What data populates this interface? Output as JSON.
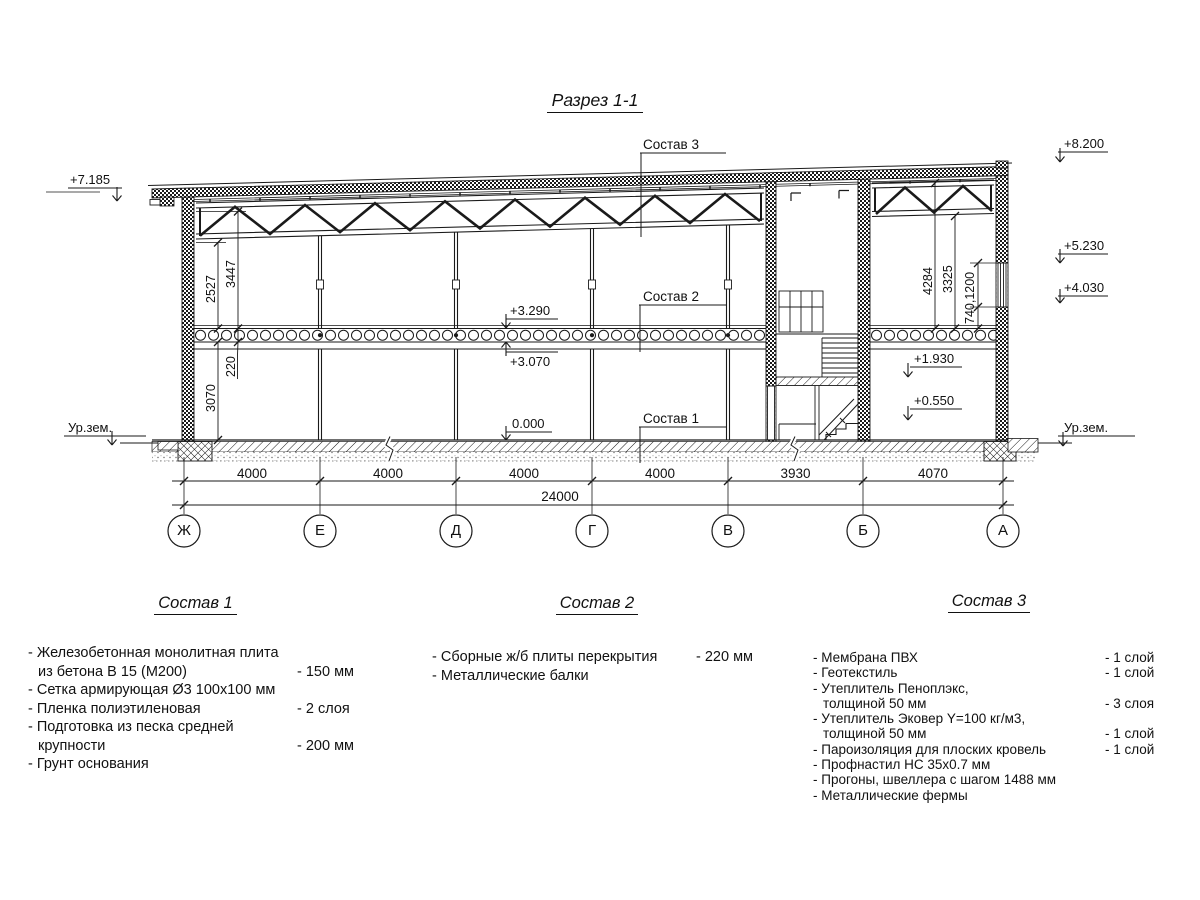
{
  "title": "Разрез 1-1",
  "drawing": {
    "elev": {
      "e7185": "+7.185",
      "urzem_left": "Ур.зем.",
      "urzem_right": "Ур.зем.",
      "e8200": "+8.200",
      "e5230": "+5.230",
      "e4030": "+4.030",
      "e3290": "+3.290",
      "e3070": "+3.070",
      "e0000": "0.000",
      "e1930": "+1.930",
      "e0550": "+0.550"
    },
    "callouts": {
      "c1": "Состав 1",
      "c2": "Состав 2",
      "c3": "Состав 3"
    },
    "vdims": {
      "left": [
        "2527",
        "3447",
        "220",
        "3070"
      ],
      "right": [
        "4284",
        "3325",
        "740,1200"
      ]
    },
    "spans": [
      "4000",
      "4000",
      "4000",
      "4000",
      "3930",
      "4070"
    ],
    "total": "24000",
    "axes": [
      "Ж",
      "Е",
      "Д",
      "Г",
      "В",
      "Б",
      "А"
    ]
  },
  "legend": {
    "s1": {
      "title": "Состав 1",
      "rows": [
        {
          "text": "- Железобетонная  монолитная плита"
        },
        {
          "text": "из бетона В 15 (М200)",
          "value": "- 150 мм"
        },
        {
          "text": "- Сетка армирующая Ø3 100х100 мм"
        },
        {
          "text": "- Пленка полиэтиленовая",
          "value": "-  2 слоя"
        },
        {
          "text": "- Подготовка из песка средней"
        },
        {
          "text": "крупности",
          "value": "- 200 мм"
        },
        {
          "text": "- Грунт основания"
        }
      ]
    },
    "s2": {
      "title": "Состав 2",
      "rows": [
        {
          "text": "- Сборные ж/б плиты перекрытия",
          "value": "- 220 мм"
        },
        {
          "text": "- Металлические балки"
        }
      ]
    },
    "s3": {
      "title": "Состав 3",
      "rows": [
        {
          "text": "- Мембрана ПВХ",
          "value": "- 1 слой"
        },
        {
          "text": "- Геотекстиль",
          "value": "- 1 слой"
        },
        {
          "text": "- Утеплитель Пеноплэкс,"
        },
        {
          "text": "толщиной 50 мм",
          "value": "- 3 слоя"
        },
        {
          "text": "- Утеплитель Эковер Y=100 кг/м3,"
        },
        {
          "text": "толщиной 50 мм",
          "value": "- 1 слой"
        },
        {
          "text": "- Пароизоляция для плоских кровель",
          "value": "- 1 слой"
        },
        {
          "text": "- Профнастил НС 35х0.7 мм"
        },
        {
          "text": "- Прогоны, швеллера с шагом 1488 мм"
        },
        {
          "text": "- Металлические фермы"
        }
      ]
    }
  }
}
